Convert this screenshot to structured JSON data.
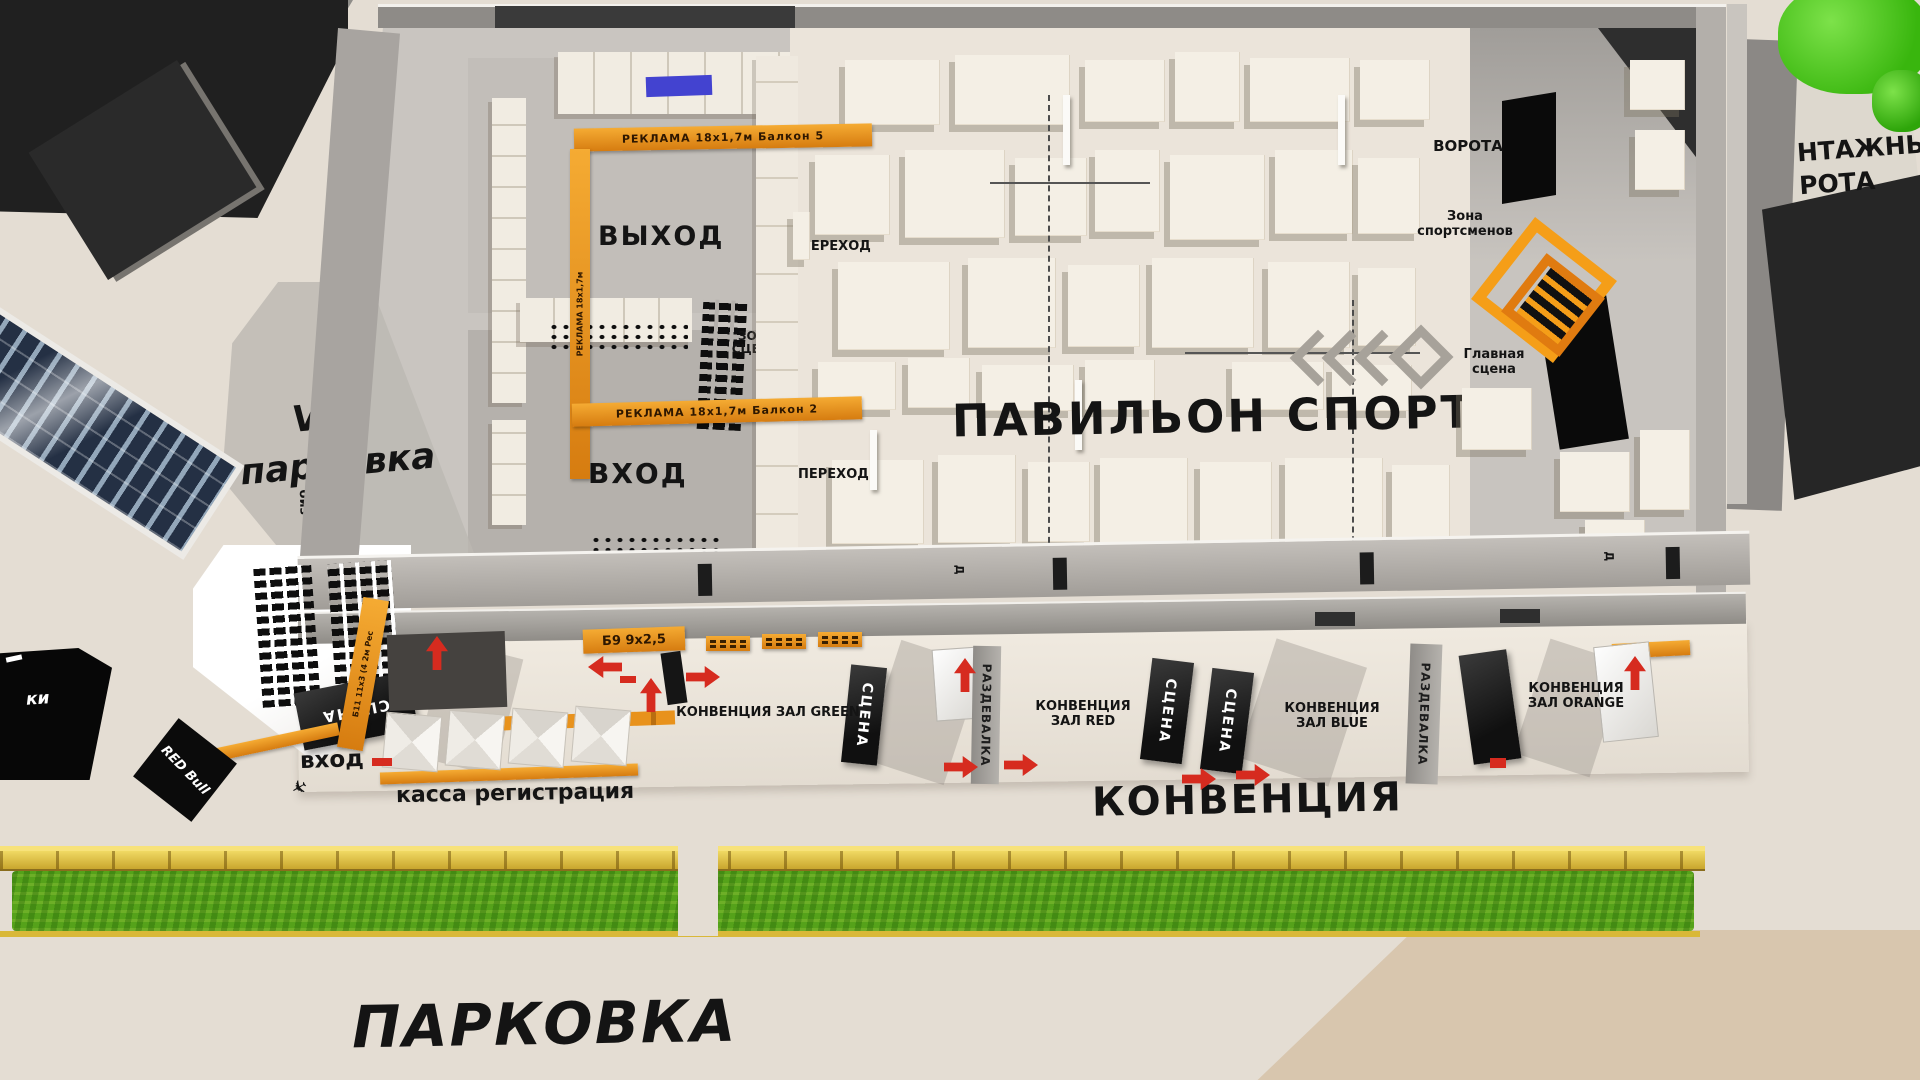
{
  "colors": {
    "accent_orange": "#e8921c",
    "arrow_red": "#d62b1f",
    "grass_green": "#55a21a",
    "fence_yellow": "#d8b93a",
    "stage_black": "#141414"
  },
  "pavilion": {
    "title": "ПАВИЛЬОН СПОРТ",
    "exit": "ВЫХОД",
    "entrance": "ВХОД",
    "passage_top": "ПЕРЕХОД",
    "passage_bottom": "ПЕРЕХОД",
    "stage_zone_line1": "ЗОНА",
    "stage_zone_line2": "СЦЕНЫ",
    "banner_balcony5": "РЕКЛАМА 18х1,7м  Балкон 5",
    "banner_balcony2": "РЕКЛАМА 18х1,7м  Балкон 2",
    "banner_side": "РЕКЛАМА 18х1,7м",
    "gates": "ВОРОТА",
    "athletes_line1": "Зона",
    "athletes_line2": "спортсменов",
    "main_stage_line1": "Главная",
    "main_stage_line2": "сцена",
    "wall_label": "Д"
  },
  "convention": {
    "title": "КОНВЕНЦИЯ",
    "entrance": "вход",
    "registration": "касса регистрация",
    "banner_b9": "Б9 9х2,5",
    "banner_b11": "Б11 11х3 (4 2м Рес",
    "hall_green": "КОНВЕНЦИЯ  ЗАЛ GREEN",
    "hall_red_line1": "КОНВЕНЦИЯ",
    "hall_red_line2": "ЗАЛ RED",
    "hall_blue_line1": "КОНВЕНЦИЯ",
    "hall_blue_line2": "ЗАЛ BLUE",
    "hall_orange_line1": "КОНВЕНЦИЯ",
    "hall_orange_line2": "ЗАЛ ORANGE",
    "stage": "СЦЕНА",
    "dressing": "РАЗДЕВАЛКА"
  },
  "exterior": {
    "vip_line1": "VIP",
    "vip_line2": "парковка",
    "parking": "ПАРКОВКА",
    "redbull": "RED Bull",
    "biz": "биз",
    "gates_partial_line1": "НТАЖНЫЕ",
    "gates_partial_line2": "РОТА",
    "left_banner": "ки",
    "vip_stage": "СЦЕНА"
  }
}
